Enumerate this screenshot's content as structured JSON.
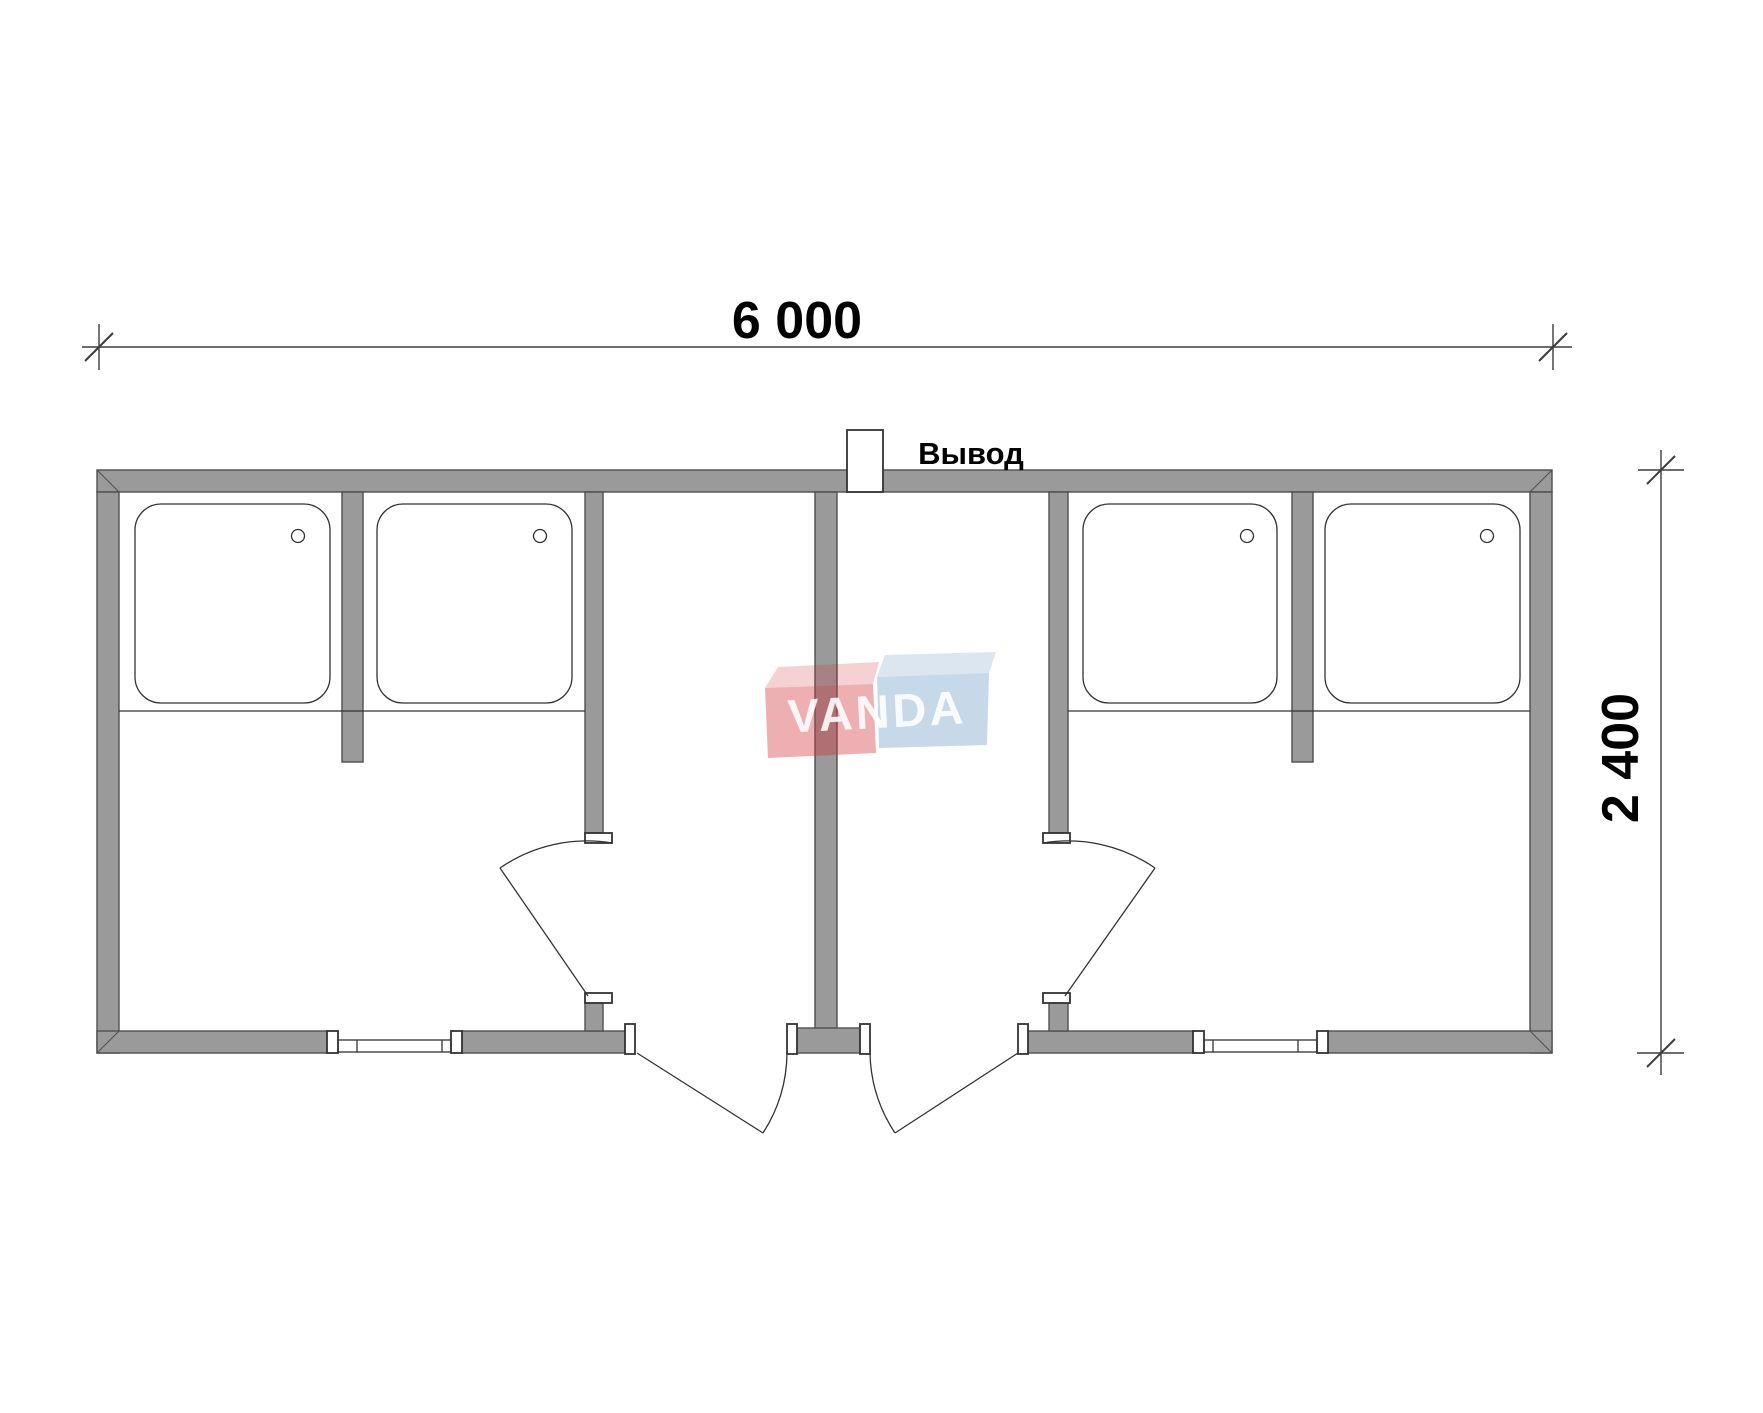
{
  "drawing": {
    "title": "Floor plan of modular shower block (two mirrored units)",
    "units_count": 2,
    "shower_trays_count": 4
  },
  "dims": {
    "width_label": "6 000",
    "height_label": "2 400"
  },
  "outlet": {
    "label": "Вывод"
  },
  "logo": {
    "text": "VANDA"
  },
  "colors": {
    "wall_fill": "#9a9a9a",
    "wall_stroke": "#4f4f4f",
    "line": "#333333",
    "dim": "#3c3c3c",
    "text": "#000000",
    "logo_red": "rgba(210,45,55,0.38)",
    "logo_red_flap": "rgba(210,45,55,0.22)",
    "logo_blue": "rgba(90,140,190,0.34)",
    "logo_blue_flap": "rgba(90,140,190,0.22)",
    "logo_text": "rgba(255,255,255,0.88)"
  }
}
